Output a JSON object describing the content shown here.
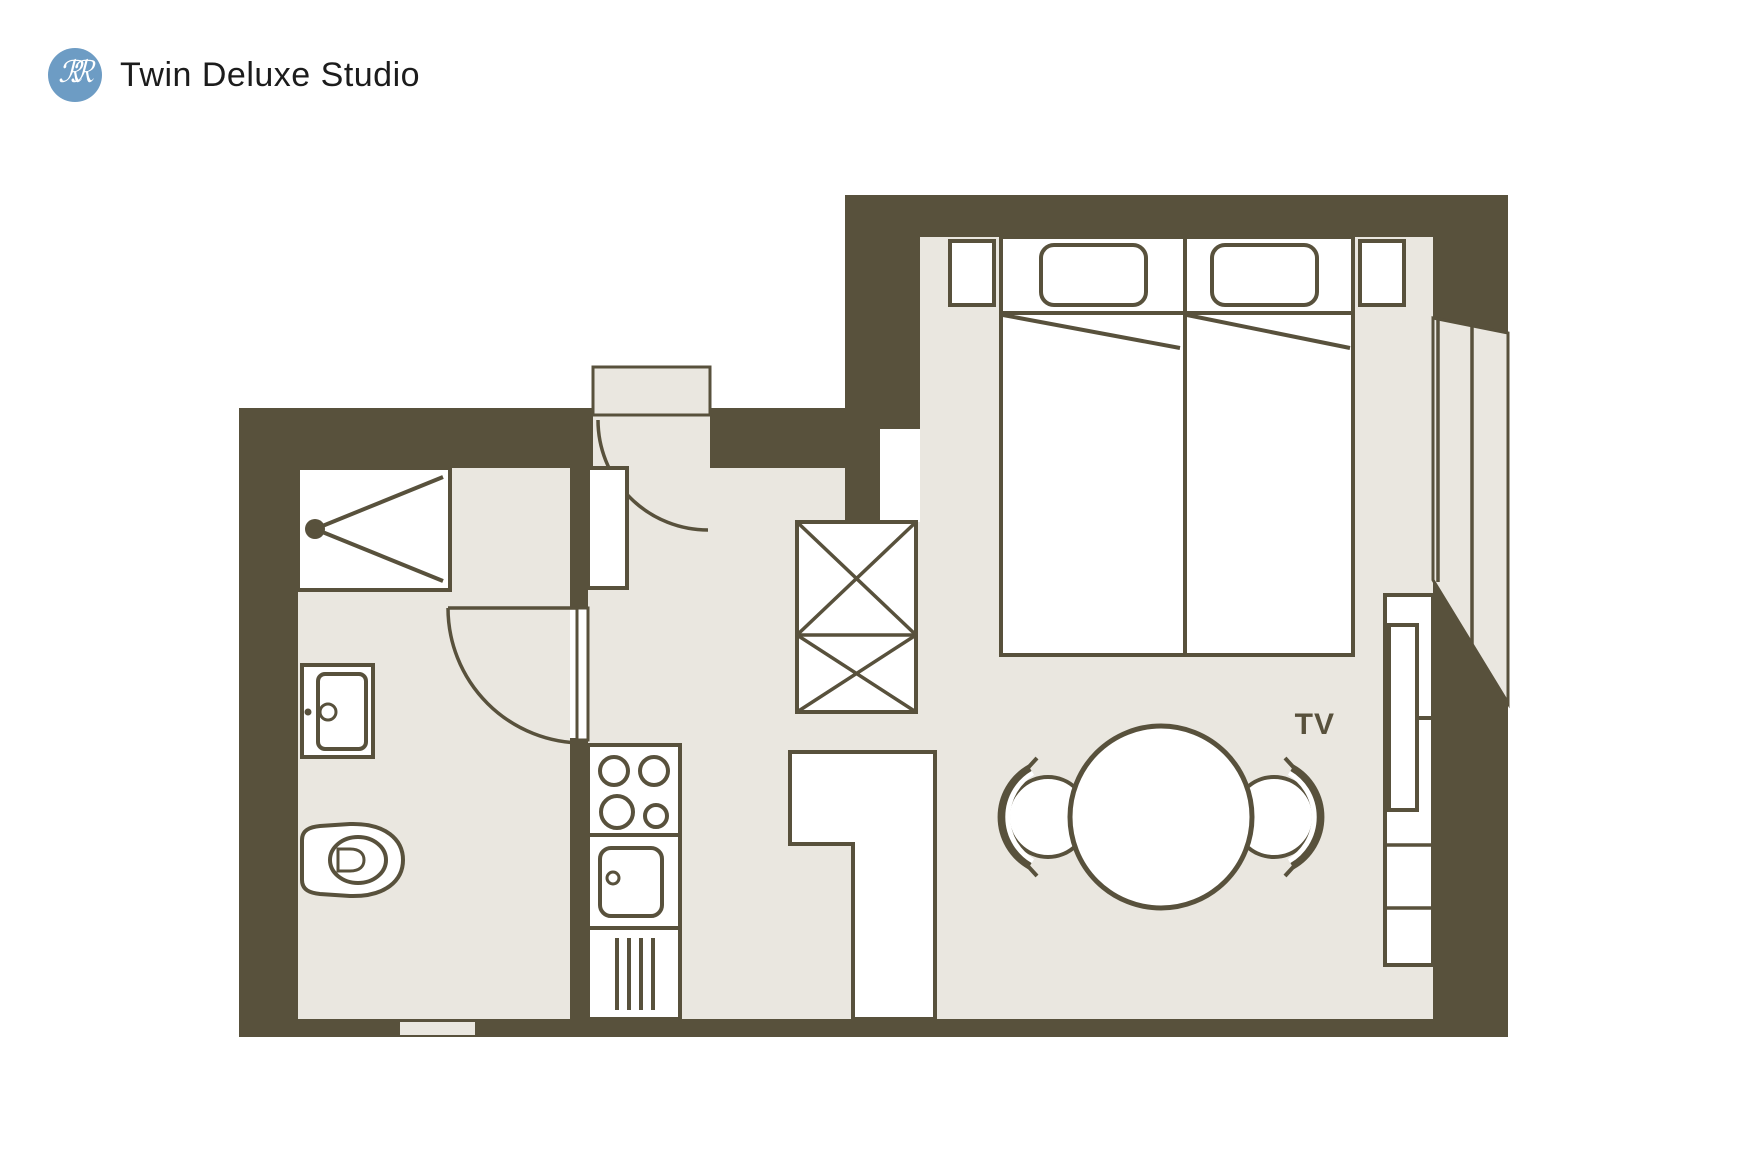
{
  "header": {
    "logo_letters": "ℛℛ",
    "title": "Twin Deluxe Studio"
  },
  "plan": {
    "tv_label": "TV",
    "furniture": [
      "shower",
      "bathroom-sink",
      "toilet",
      "bathroom-door",
      "entry-door",
      "tall-cabinet",
      "stove-4-burners",
      "kitchen-sink",
      "dishwasher",
      "wardrobe-crossed",
      "twin-bed-left",
      "twin-bed-right",
      "nightstand-left",
      "nightstand-right",
      "l-shaped-counter",
      "round-table",
      "chair-left",
      "chair-right",
      "tv-sideboard",
      "angled-window-bay",
      "entry-threshold",
      "bottom-wall-threshold"
    ]
  },
  "colors": {
    "wall": "#58513C",
    "floor": "#EAE7E0",
    "white": "#FFFFFF",
    "logo_blue": "#6D9CC4",
    "title_text": "#1C1C1C",
    "background": "#FFFFFF"
  }
}
